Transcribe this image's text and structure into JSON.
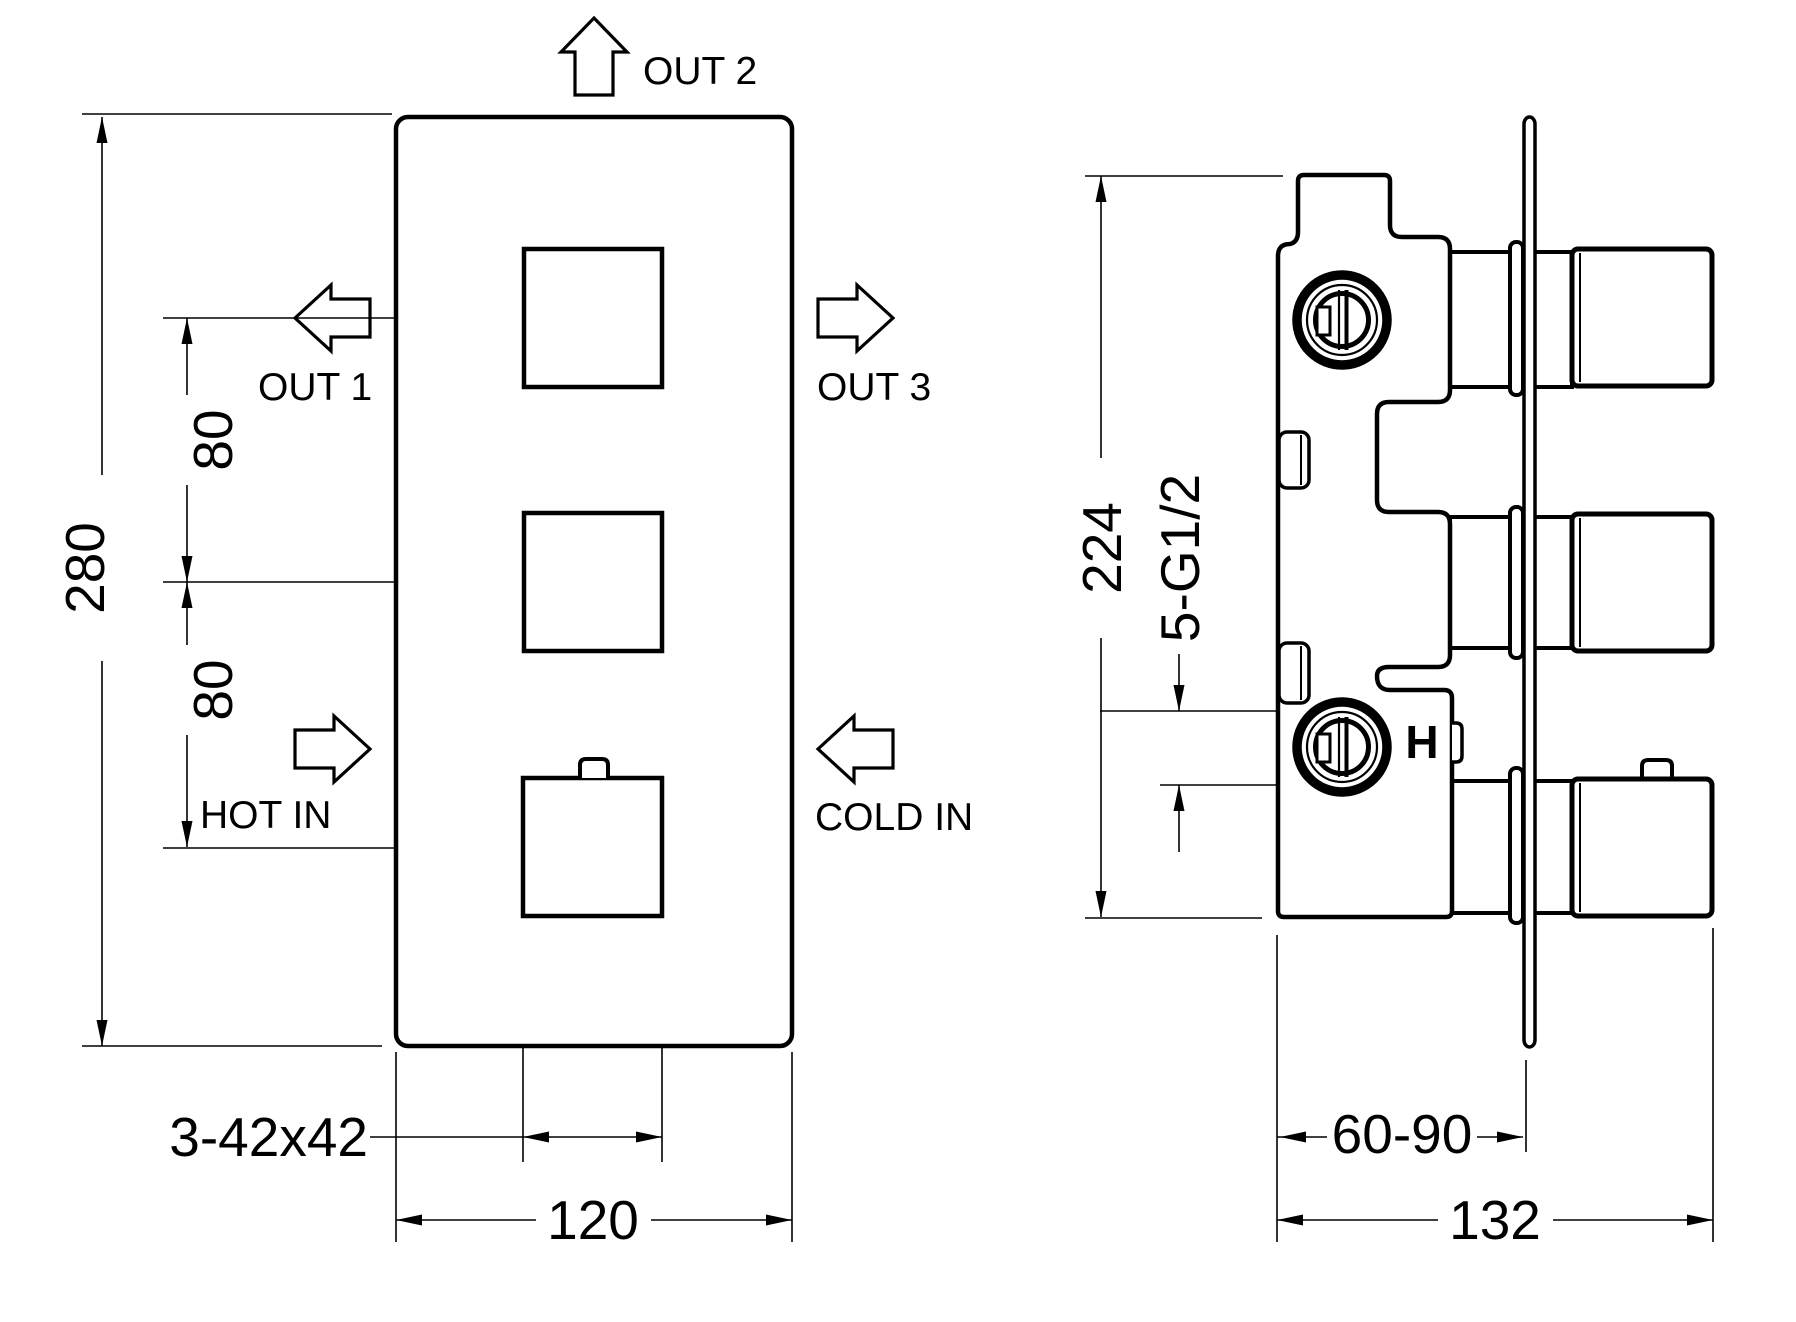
{
  "drawing": {
    "title": "thermostatic-valve-technical-drawing",
    "front_view": {
      "out2_label": "OUT 2",
      "out1_label": "OUT 1",
      "out3_label": "OUT 3",
      "hot_in_label": "HOT IN",
      "cold_in_label": "COLD IN",
      "dim_height": "280",
      "dim_spacing_upper": "80",
      "dim_spacing_lower": "80",
      "dim_handles": "3-42x42",
      "dim_width": "120"
    },
    "side_view": {
      "dim_height": "224",
      "dim_ports": "5-G1/2",
      "dim_depth_range": "60-90",
      "dim_total_depth": "132",
      "hot_marker": "H"
    },
    "colors": {
      "line": "#000000",
      "background": "#ffffff"
    }
  }
}
